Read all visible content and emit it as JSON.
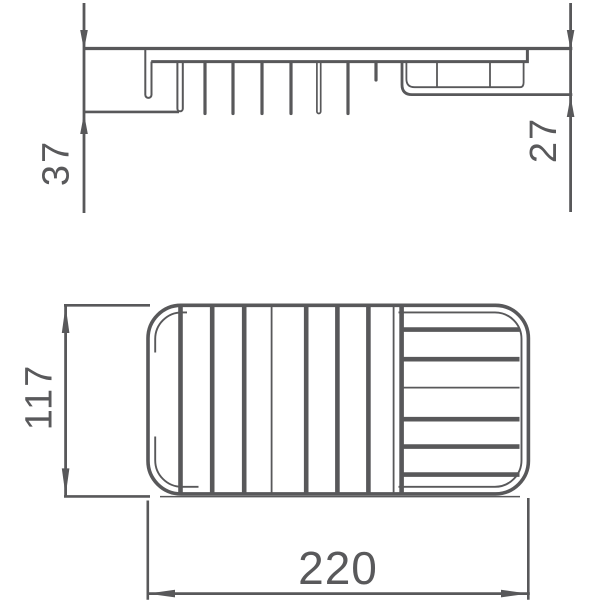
{
  "drawing": {
    "kind": "technical-dimension-drawing",
    "line_color": "#58585a",
    "text_color": "#59595b",
    "background": "#ffffff",
    "dimensions": {
      "side_height_left": {
        "label": "37"
      },
      "side_height_right": {
        "label": "27"
      },
      "plan_depth": {
        "label": "117"
      },
      "plan_width": {
        "label": "220"
      }
    }
  }
}
